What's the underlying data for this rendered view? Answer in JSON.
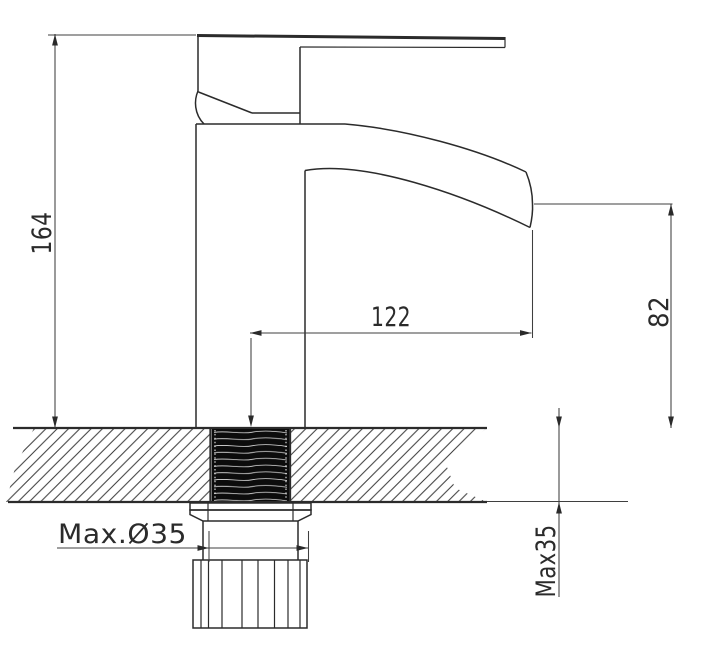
{
  "drawing": {
    "subject": "basin mixer tap installation drawing",
    "dimensions": {
      "overall_height": "164",
      "spout_reach": "122",
      "spout_outlet_height": "82",
      "max_hole_diameter": "Max.Ø35",
      "max_deck_thickness": "Max35"
    },
    "colors": {
      "background": "#ffffff",
      "outline": "#2b2b2b",
      "dimension_line": "#3f3f3f",
      "thread_fill": "#0c0c0c"
    }
  }
}
